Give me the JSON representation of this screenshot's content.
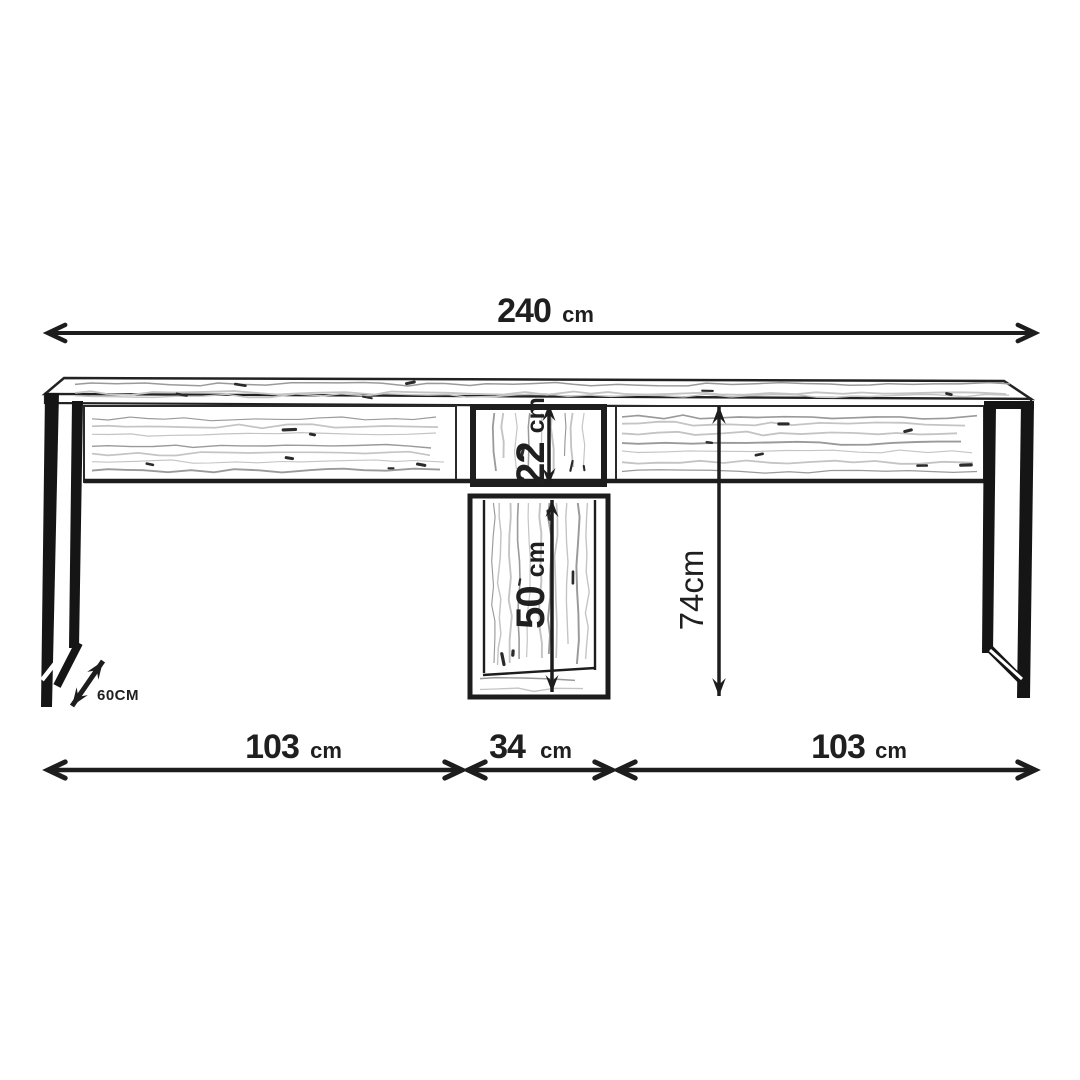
{
  "diagram": {
    "subject": "double-desk dimension drawing",
    "background": "#ffffff",
    "ink": "#222222",
    "grain_light": "#c4c4c4",
    "grain_dark": "#9a9a9a",
    "dimensions": {
      "total_width": {
        "value": "240",
        "unit": "cm"
      },
      "left_span": {
        "value": "103",
        "unit": "cm"
      },
      "center_span": {
        "value": "34",
        "unit": "cm"
      },
      "right_span": {
        "value": "103",
        "unit": "cm"
      },
      "upper_cubby_height": {
        "value": "22",
        "unit": "cm"
      },
      "lower_cabinet_height": {
        "value": "50",
        "unit": "cm"
      },
      "desk_height": {
        "value": "74cm"
      },
      "depth": {
        "value": "60CM"
      }
    }
  }
}
